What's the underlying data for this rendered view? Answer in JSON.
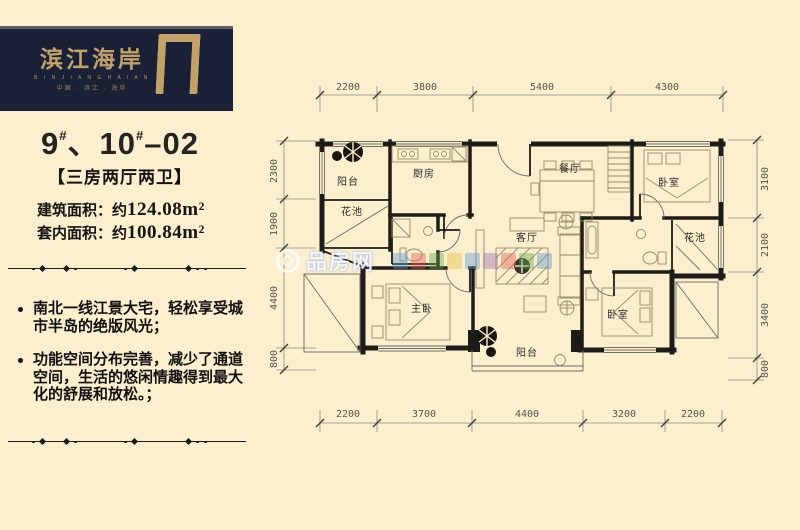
{
  "page": {
    "bg": "#fbefce"
  },
  "brand": {
    "name": "滨江海岸",
    "latin": "B I N J I A N G H A I A N",
    "tagline": "中国 · 滨江 · 海岸",
    "panel_bg": "#1a2136",
    "gold": "#c3a269"
  },
  "unit": {
    "n1": "9",
    "s1": "#",
    "sep": "、",
    "n2": "10",
    "s2": "#",
    "tail": "–02",
    "tag": "【三房两厅两卫】"
  },
  "areas": {
    "built_label": "建筑面积：约",
    "built_value": "124.08m²",
    "inner_label": "套内面积：约",
    "inner_value": "100.84m²"
  },
  "features": [
    "南北一线江景大宅，轻松享受城市半岛的绝版风光；",
    "功能空间分布完善，减少了通道空间，生活的悠闲情趣得到最大化的舒展和放松。；"
  ],
  "watermark": {
    "site": "品房网",
    "sep": "·"
  },
  "plan": {
    "rooms": {
      "balcony_top": "阳台",
      "flower_left": "花池",
      "kitchen": "厨房",
      "dining": "餐厅",
      "bedroom_tr": "卧室",
      "flower_right": "花池",
      "living": "客厅",
      "master": "主卧",
      "balcony_bottom": "阳台",
      "bedroom_br": "卧室"
    },
    "dims": {
      "top": [
        "2200",
        "3800",
        "5400",
        "4300"
      ],
      "bottom": [
        "2200",
        "3700",
        "4400",
        "3200",
        "2200"
      ],
      "left": [
        "2300",
        "1900",
        "4400",
        "800"
      ],
      "right": [
        "3100",
        "2100",
        "3400",
        "800"
      ]
    }
  }
}
